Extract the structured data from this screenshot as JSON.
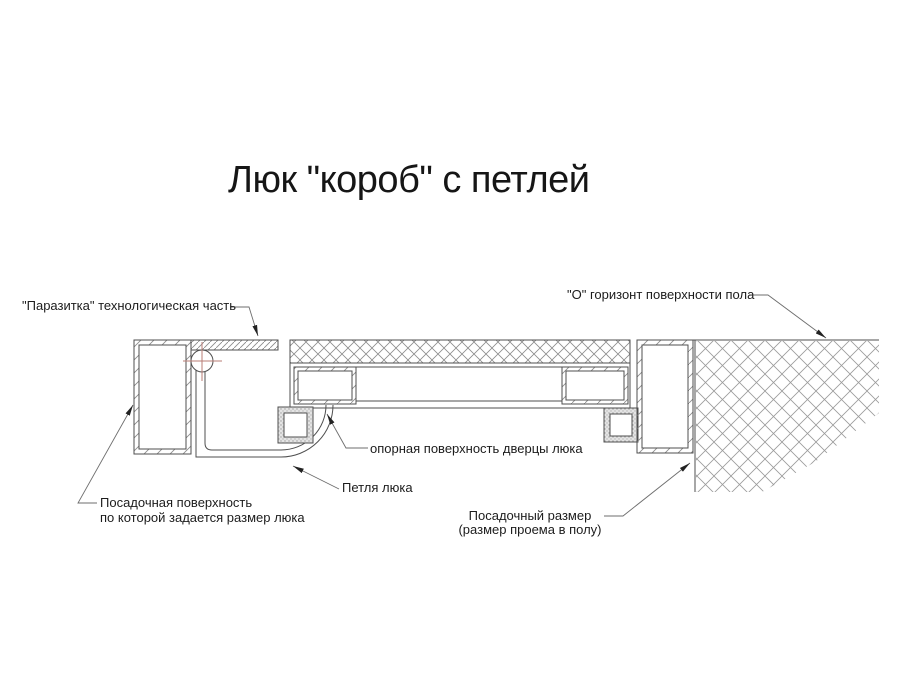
{
  "title": "Люк \"короб\" с петлей",
  "callouts": {
    "parasite_part": "\"Паразитка\" технологическая часть",
    "floor_horizon": "\"О\" горизонт поверхности пола",
    "door_bearing_surface": "опорная поверхность дверцы люка",
    "hinge": "Петля люка",
    "seating_surface": {
      "line1": "Посадочная поверхность",
      "line2": "по которой задается размер люка"
    },
    "seating_size": {
      "line1": "Посадочный размер",
      "line2": "(размер проема в полу)"
    }
  },
  "colors": {
    "line": "#4f4f4f",
    "hatch": "#8c8c8c",
    "leader": "#6e6e6e",
    "centerline_red": "#b97c76",
    "text": "#1c1c1c",
    "background": "#ffffff"
  }
}
